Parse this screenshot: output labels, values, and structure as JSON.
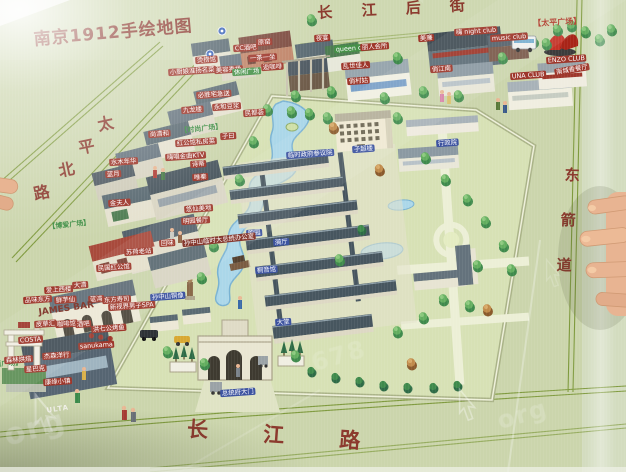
{
  "title": "南京1912手绘地图",
  "palette": {
    "map_green": "#cbd5ac",
    "lawn": "#d7e1b5",
    "path_cream": "#ecefd6",
    "road_line": "#7f9a3e",
    "street_text": "#8c3a2e",
    "title_text": "#8c3a30",
    "red_label": "#9e372b",
    "blue_label": "#3d53a0",
    "green_label": "#469148",
    "roof_slate": "#47565f",
    "roof_red": "#a84a3c",
    "wall_cream": "#eae6d2",
    "pond_blue": "#abd7e9",
    "tree_green": "#4f9653",
    "skin": "#e8b492"
  },
  "map_labels": [
    {
      "n": "street-changjiang-houjie",
      "tp": "street",
      "t": "长 江 后 街",
      "x": 317,
      "y": 5,
      "fs": 15,
      "ls": 12,
      "r": -3,
      "sc": 1
    },
    {
      "n": "street-taiping-north-1",
      "tp": "street",
      "t": "太",
      "x": 96,
      "y": 117,
      "fs": 16,
      "r": -12,
      "sc": 1
    },
    {
      "n": "street-taiping-north-2",
      "tp": "street",
      "t": "平",
      "x": 77,
      "y": 140,
      "fs": 16,
      "r": -12,
      "sc": 1
    },
    {
      "n": "street-taiping-north-3",
      "tp": "street",
      "t": "北",
      "x": 57,
      "y": 163,
      "fs": 16,
      "r": -12,
      "sc": 1
    },
    {
      "n": "street-taiping-north-4",
      "tp": "street",
      "t": "路",
      "x": 32,
      "y": 186,
      "fs": 16,
      "r": -12,
      "sc": 1
    },
    {
      "n": "street-changjiang-lu",
      "tp": "street",
      "t": "长 江 路",
      "x": 188,
      "y": 417,
      "fs": 21,
      "ls": 24,
      "r": 4,
      "sc": 1
    },
    {
      "n": "street-dongjiandao-1",
      "tp": "street",
      "t": "东",
      "x": 565,
      "y": 167,
      "fs": 15,
      "r": 2,
      "sc": 1
    },
    {
      "n": "street-dongjiandao-2",
      "tp": "street",
      "t": "箭",
      "x": 561,
      "y": 212,
      "fs": 15,
      "r": 2,
      "sc": 1
    },
    {
      "n": "street-dongjiandao-3",
      "tp": "street",
      "t": "道",
      "x": 557,
      "y": 257,
      "fs": 15,
      "r": 2,
      "sc": 1
    },
    {
      "n": "label-taiping-square",
      "tp": "bracket-red",
      "t": "【太平广场】",
      "x": 533,
      "y": 19,
      "fs": 8,
      "r": -3,
      "sc": 1
    },
    {
      "n": "label-boai-square",
      "tp": "bracket-green",
      "t": "【博爱广场】",
      "x": 48,
      "y": 223,
      "fs": 7,
      "r": -6,
      "sc": 1
    },
    {
      "n": "label-fashion-square",
      "tp": "bracket-green",
      "t": "【时尚广场】",
      "x": 180,
      "y": 127,
      "fs": 7,
      "r": -6,
      "sc": 1
    },
    {
      "n": "label-west-square",
      "tp": "bracket-green",
      "t": "【西广场】",
      "x": -13,
      "y": 361,
      "fs": 7,
      "r": -4,
      "sc": 1
    },
    {
      "n": "label-zichaolou",
      "t": "子超楼",
      "tp": "blue",
      "x": 352,
      "y": 146
    },
    {
      "n": "label-xingzhengyuan",
      "t": "行政院",
      "tp": "blue",
      "x": 436,
      "y": 140
    },
    {
      "n": "label-canyiyuan",
      "t": "临时政府参议院",
      "tp": "blue",
      "x": 286,
      "y": 152
    },
    {
      "n": "label-xuyuan",
      "t": "煦园",
      "tp": "blue",
      "x": 246,
      "y": 230
    },
    {
      "n": "label-yiting",
      "t": "漪厅",
      "tp": "blue",
      "x": 273,
      "y": 239
    },
    {
      "n": "label-tongyinguan",
      "t": "桐音馆",
      "tp": "blue",
      "x": 255,
      "y": 267
    },
    {
      "n": "label-sun-statue",
      "t": "孙中山铜像",
      "tp": "blue",
      "x": 150,
      "y": 294
    },
    {
      "n": "label-datang",
      "t": "大堂",
      "tp": "blue",
      "x": 275,
      "y": 319
    },
    {
      "n": "label-palace-gate",
      "t": "总统府大门",
      "tp": "blue",
      "x": 220,
      "y": 390
    },
    {
      "n": "label-sun-office",
      "t": "孙中山临时大总统办公室",
      "tp": "darkred",
      "x": 182,
      "y": 240,
      "r": -6
    },
    {
      "t": "烫捞馆",
      "x": 195,
      "y": 57
    },
    {
      "t": "CC酒吧",
      "x": 233,
      "y": 45
    },
    {
      "t": "原窑",
      "x": 256,
      "y": 39
    },
    {
      "t": "一茶一坐",
      "x": 248,
      "y": 55
    },
    {
      "t": "逅咖啡",
      "x": 261,
      "y": 64
    },
    {
      "t": "小厨娘淮扬名菜",
      "x": 168,
      "y": 69
    },
    {
      "t": "美容秀场",
      "x": 214,
      "y": 67
    },
    {
      "t": "必胜宅急送",
      "x": 196,
      "y": 92
    },
    {
      "t": "九龙楼",
      "x": 181,
      "y": 107
    },
    {
      "t": "永和豆浆",
      "x": 212,
      "y": 104
    },
    {
      "t": "民都荟",
      "x": 243,
      "y": 110
    },
    {
      "t": "尚清和",
      "x": 148,
      "y": 131
    },
    {
      "t": "红公馆私房菜",
      "x": 175,
      "y": 140
    },
    {
      "t": "子曰",
      "x": 220,
      "y": 133
    },
    {
      "t": "嗨唱金曲KTV",
      "x": 165,
      "y": 154
    },
    {
      "t": "诗蒂",
      "x": 190,
      "y": 161
    },
    {
      "t": "唯秦",
      "x": 192,
      "y": 174
    },
    {
      "t": "水木年华",
      "x": 109,
      "y": 159
    },
    {
      "t": "蓝月",
      "x": 105,
      "y": 171
    },
    {
      "t": "金夫人",
      "x": 108,
      "y": 200
    },
    {
      "t": "悠仙美地",
      "x": 184,
      "y": 206
    },
    {
      "t": "明园餐厅",
      "x": 181,
      "y": 218
    },
    {
      "t": "回味",
      "x": 159,
      "y": 240
    },
    {
      "t": "苏荷老站",
      "x": 124,
      "y": 249
    },
    {
      "t": "民国红公馆",
      "x": 96,
      "y": 265
    },
    {
      "t": "大清",
      "x": 72,
      "y": 282
    },
    {
      "t": "爱上西楼",
      "x": 44,
      "y": 287
    },
    {
      "t": "品味东方",
      "x": 23,
      "y": 297
    },
    {
      "t": "鲜芋仙",
      "x": 54,
      "y": 297
    },
    {
      "t": "蓝湾",
      "x": 88,
      "y": 296
    },
    {
      "t": "东方寿司",
      "x": 102,
      "y": 297
    },
    {
      "n": "label-james-bar",
      "t": "JAMES BAR",
      "tp": "maroon",
      "x": 38,
      "y": 308,
      "fs": 9,
      "r": -8,
      "sc": 1
    },
    {
      "t": "新视界男子SPA",
      "x": 108,
      "y": 304
    },
    {
      "t": "皮草汇",
      "x": 34,
      "y": 321
    },
    {
      "t": "咖啡馆",
      "x": 55,
      "y": 321
    },
    {
      "t": "酒吧",
      "x": 75,
      "y": 321
    },
    {
      "t": "洪七公烤鱼",
      "x": 91,
      "y": 326
    },
    {
      "t": "sanukama",
      "x": 78,
      "y": 343
    },
    {
      "n": "label-costa",
      "t": "COSTA",
      "x": 18,
      "y": 337
    },
    {
      "t": "杰森洋行",
      "x": 42,
      "y": 353
    },
    {
      "t": "森林烘焙",
      "x": 4,
      "y": 357
    },
    {
      "n": "label-starbucks",
      "t": "星巴克",
      "x": 24,
      "y": 366
    },
    {
      "t": "康缘小镇",
      "x": 43,
      "y": 379
    },
    {
      "n": "label-ulta",
      "t": "ULTA",
      "tp": "white-sm",
      "x": 44,
      "y": 407,
      "fs": 7,
      "r": -8,
      "sc": 1
    },
    {
      "t": "夜宴",
      "x": 314,
      "y": 35
    },
    {
      "n": "label-queen-club",
      "t": "queen club",
      "tp": "green",
      "x": 334,
      "y": 46
    },
    {
      "t": "丽人会所",
      "x": 360,
      "y": 44
    },
    {
      "t": "乱世佳人",
      "x": 341,
      "y": 63
    },
    {
      "t": "俏村姑",
      "x": 347,
      "y": 78
    },
    {
      "t": "美廉",
      "x": 418,
      "y": 35
    },
    {
      "n": "label-night-club",
      "t": "嗨 night club",
      "x": 454,
      "y": 29
    },
    {
      "n": "label-music-club",
      "t": "music club",
      "x": 490,
      "y": 35
    },
    {
      "t": "俏江南",
      "x": 430,
      "y": 66
    },
    {
      "n": "label-una-club",
      "t": "UNA CLUB",
      "x": 510,
      "y": 73
    },
    {
      "n": "label-enzo-club",
      "t": "ENZO CLUB",
      "x": 546,
      "y": 57
    },
    {
      "t": "南城香餐厅",
      "x": 554,
      "y": 69,
      "r": -10
    },
    {
      "tp": "green",
      "t": "休闲广场",
      "x": 232,
      "y": 69
    }
  ],
  "watermarks": [
    {
      "t": "org",
      "x": 0,
      "y": 420,
      "fs": 30,
      "r": -16,
      "o": 0.45
    },
    {
      "t": "678",
      "x": 308,
      "y": 350,
      "fs": 24,
      "r": -16,
      "o": 0.22
    },
    {
      "t": "org",
      "x": 494,
      "y": 408,
      "fs": 24,
      "r": -16,
      "o": 0.3
    }
  ],
  "photo_artifacts": {
    "hand_right": "hand pointing at map from right edge",
    "fingertip_left": "fingertip at left edge",
    "glare": "white glare top-left corner and right streak"
  }
}
